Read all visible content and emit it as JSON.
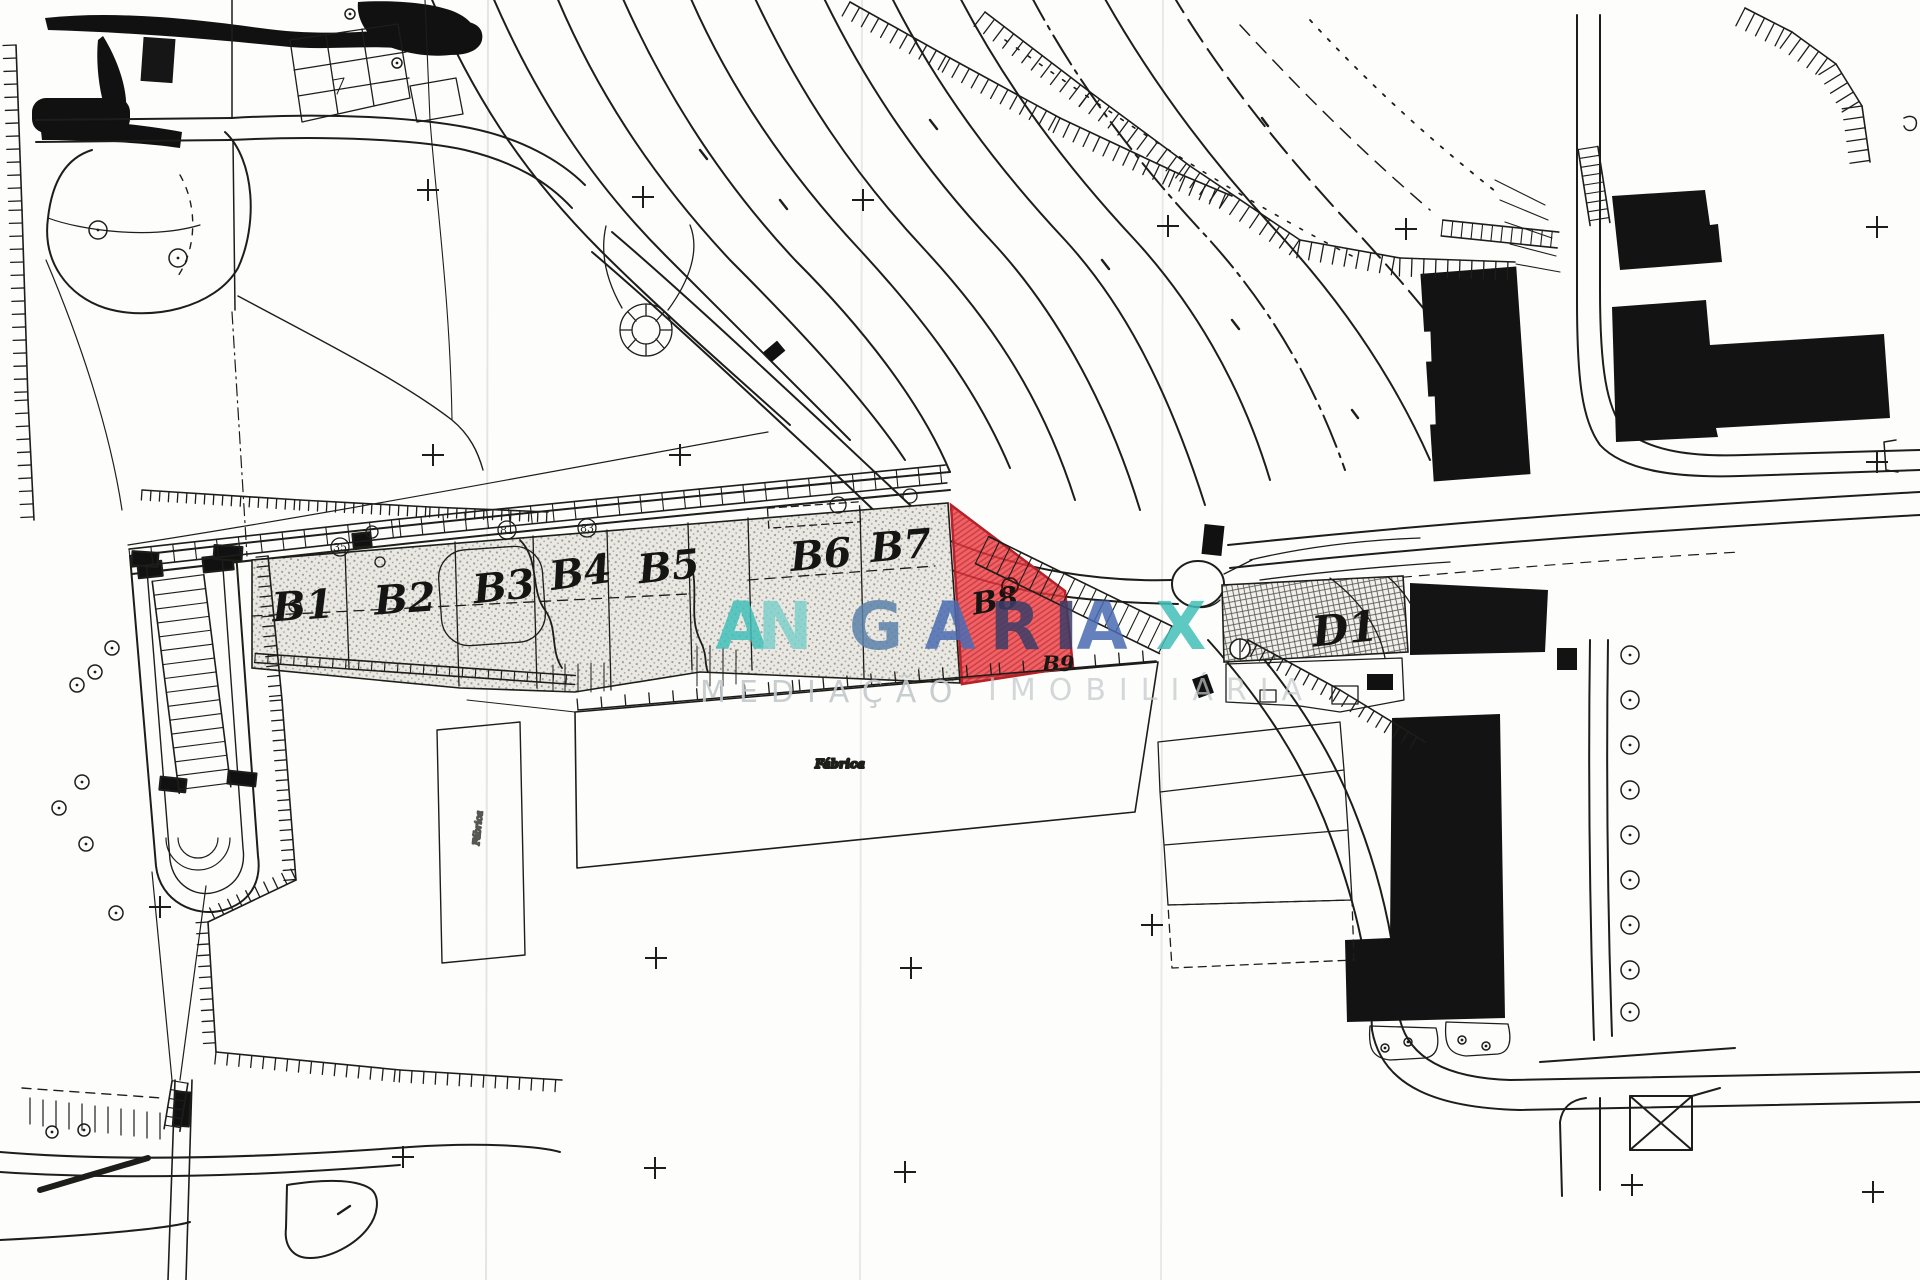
{
  "map": {
    "lots": {
      "items": [
        {
          "label": "B1"
        },
        {
          "label": "B2"
        },
        {
          "label": "B3"
        },
        {
          "label": "B4"
        },
        {
          "label": "B5"
        },
        {
          "label": "B6"
        },
        {
          "label": "B7"
        }
      ]
    },
    "highlighted_parcel": {
      "label": "B8",
      "secondary_label": "B9",
      "fill": "#ee3940",
      "edge": "#b5222a",
      "hatch": "#a01d22"
    },
    "building_d1": {
      "label": "D1"
    },
    "annotations": {
      "factory": "Fábrica"
    },
    "lot_markers": [
      {
        "label": "35"
      },
      {
        "label": "81"
      },
      {
        "label": "83"
      }
    ]
  },
  "watermark": {
    "brand_letters": [
      {
        "ch": "A",
        "color": "#43bfba",
        "x": 741
      },
      {
        "ch": "N",
        "color": "#7ed0cb",
        "x": 785
      },
      {
        "ch": "G",
        "color": "#5d83ab",
        "x": 876
      },
      {
        "ch": "A",
        "color": "#4a6cb3",
        "x": 950
      },
      {
        "ch": "R",
        "color": "#3c3e68",
        "x": 1015
      },
      {
        "ch": "I",
        "color": "#3c3e68",
        "x": 1066
      },
      {
        "ch": "A",
        "color": "#4a6cb3",
        "x": 1102
      },
      {
        "ch": "X",
        "color": "#43bfba",
        "x": 1181
      }
    ],
    "tagline_word1": "MEDIAÇÃO",
    "tagline_word2": "IMOBILIÁRIA",
    "tagline_color": "#c3c8cb"
  },
  "palette": {
    "paper": "#fdfdfb",
    "ink": "#1d1d1a"
  },
  "symbols": {
    "survey_crosses": [
      [
        428,
        190
      ],
      [
        643,
        197
      ],
      [
        863,
        200
      ],
      [
        1168,
        226
      ],
      [
        1406,
        229
      ],
      [
        1877,
        227
      ],
      [
        433,
        455
      ],
      [
        680,
        455
      ],
      [
        1877,
        462
      ],
      [
        160,
        907
      ],
      [
        1152,
        925
      ],
      [
        656,
        958
      ],
      [
        911,
        968
      ],
      [
        403,
        1157
      ],
      [
        655,
        1168
      ],
      [
        905,
        1172
      ],
      [
        1632,
        1185
      ],
      [
        1873,
        1192
      ]
    ],
    "trees": [
      [
        98,
        230,
        9
      ],
      [
        178,
        258,
        9
      ],
      [
        112,
        648,
        7
      ],
      [
        95,
        672,
        7
      ],
      [
        77,
        685,
        7
      ],
      [
        82,
        782,
        7
      ],
      [
        59,
        808,
        7
      ],
      [
        86,
        844,
        7
      ],
      [
        116,
        913,
        7
      ],
      [
        1630,
        655,
        9
      ],
      [
        1630,
        700,
        9
      ],
      [
        1630,
        745,
        9
      ],
      [
        1630,
        790,
        9
      ],
      [
        1630,
        835,
        9
      ],
      [
        1630,
        880,
        9
      ],
      [
        1630,
        925,
        9
      ],
      [
        1630,
        970,
        9
      ],
      [
        1630,
        1012,
        9
      ],
      [
        52,
        1132,
        6
      ],
      [
        84,
        1130,
        6
      ],
      [
        1385,
        1048,
        4
      ],
      [
        1408,
        1042,
        4
      ],
      [
        1462,
        1040,
        4
      ],
      [
        1486,
        1046,
        4
      ],
      [
        350,
        14,
        5
      ],
      [
        397,
        63,
        5
      ]
    ]
  }
}
